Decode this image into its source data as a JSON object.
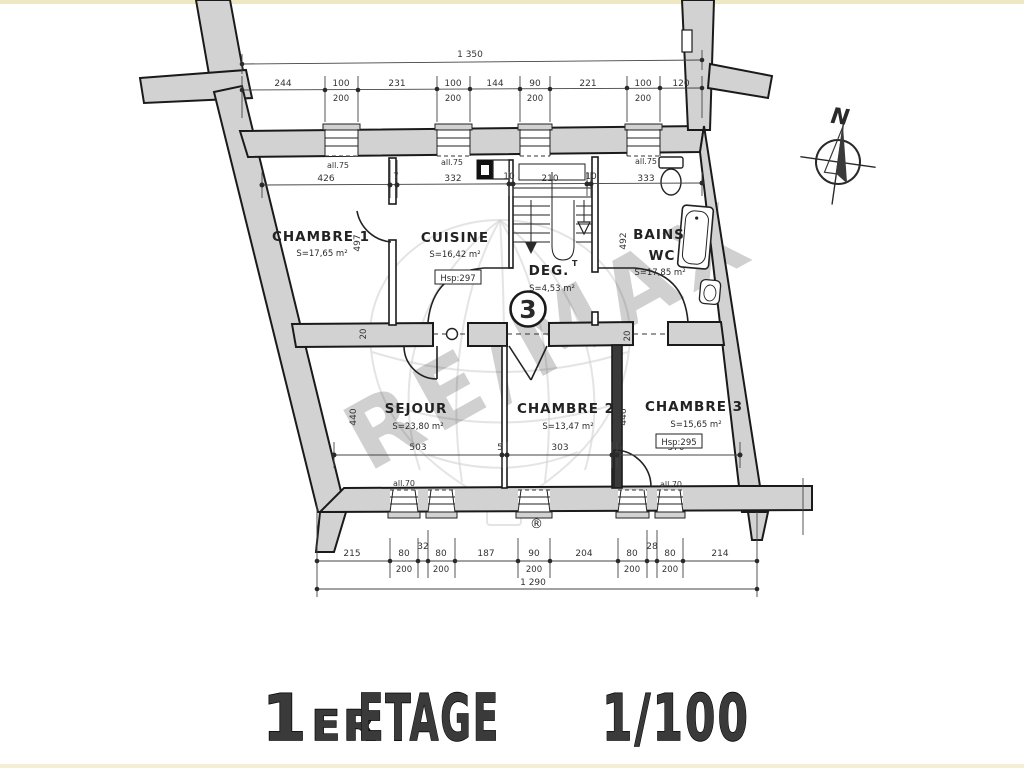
{
  "meta": {
    "north": "N"
  },
  "title": {
    "num": "1",
    "sup": "ER",
    "word": "ETAGE",
    "scale": "1/100"
  },
  "watermark": {
    "brand": "RE/MAX",
    "reg": "®"
  },
  "rooms": [
    {
      "name": "CHAMBRE 1",
      "area": "S=17,65 m²"
    },
    {
      "name": "CUISINE",
      "area": "S=16,42 m²",
      "ceiling": "Hsp:297"
    },
    {
      "name": "DEG.",
      "name_sup": "T",
      "area": "S=4,53 m²",
      "badge": "3"
    },
    {
      "name": "BAINS",
      "name2": "WC",
      "area": "S=17,85 m²"
    },
    {
      "name": "SEJOUR",
      "area": "S=23,80 m²"
    },
    {
      "name": "CHAMBRE 2",
      "area": "S=13,47 m²"
    },
    {
      "name": "CHAMBRE 3",
      "area": "S=15,65 m²",
      "ceiling": "Hsp:295"
    }
  ],
  "dimensions": {
    "overall_top": "1 350",
    "overall_bottom": "1 290",
    "top_row": [
      "244",
      "100",
      "200",
      "231",
      "100",
      "200",
      "144",
      "90",
      "200",
      "221",
      "100",
      "200",
      "120"
    ],
    "upper_room_row": [
      "426",
      "7",
      "332",
      "10",
      "210",
      "10",
      "333"
    ],
    "lower_room_row": [
      "503",
      "5",
      "303",
      "5",
      "370"
    ],
    "bottom_row": [
      "215",
      "80",
      "200",
      "32",
      "80",
      "200",
      "187",
      "90",
      "200",
      "204",
      "80",
      "200",
      "28",
      "80",
      "200",
      "214"
    ],
    "vertical": {
      "left_upper": "497",
      "left_lower": "440",
      "right_upper": "492",
      "right_lower": "446"
    },
    "wall": {
      "left": "20",
      "right": "20"
    },
    "sills": {
      "upper": "all.75",
      "lower": "all.70"
    }
  }
}
